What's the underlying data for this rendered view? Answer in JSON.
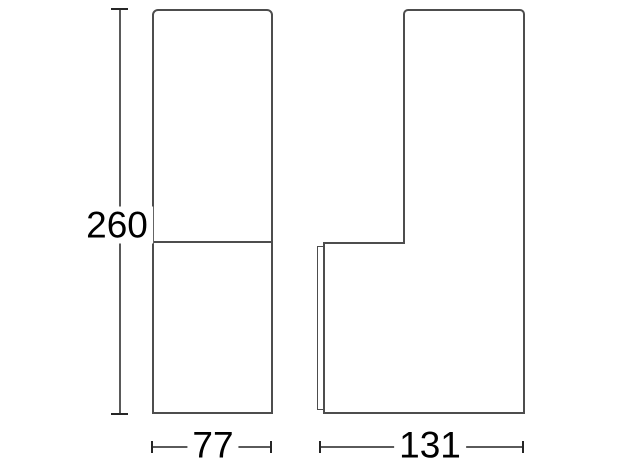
{
  "drawing": {
    "type": "technical-dimension-drawing",
    "background": "#ffffff",
    "colors": {
      "outline": "#4d4d4d",
      "dimension_line": "#5a5a5a",
      "tick": "#262626",
      "text": "#000000"
    },
    "views": {
      "front": {
        "description": "front view, tall rounded-top rectangle with horizontal divider"
      },
      "side": {
        "description": "side view, narrow stem on top of wider head with thin wall-plate edge on left"
      }
    },
    "dimensions": {
      "height": {
        "label": "260"
      },
      "front_width": {
        "label": "77"
      },
      "side_depth": {
        "label": "131"
      }
    }
  }
}
